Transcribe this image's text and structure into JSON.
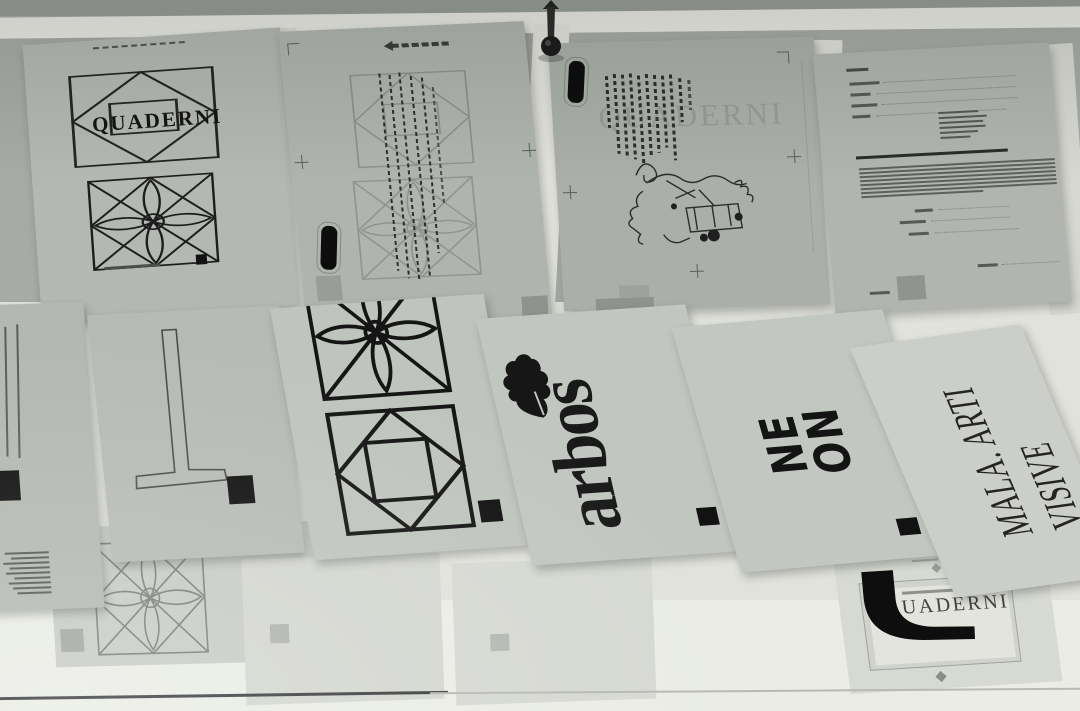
{
  "colors": {
    "ink": "#161616",
    "ink_soft": "#3f423d",
    "wall": "#a7aba5",
    "wall_bright": "#e3e4de",
    "sheet_top_row": "#b2b6b0",
    "sheet_middle_row": "#c2c6c0",
    "sheet_bottom_row": "#d6d8d2"
  },
  "icons": {
    "push_pin": "push-pin",
    "oak_leaf": "oak-leaf",
    "rosette_motif": "petal-rosette",
    "diamond_motif": "diamond-in-square",
    "q_swash": "q-swash-glyph"
  },
  "top_row": {
    "quaderni_sheet": {
      "title": "QUADERNI"
    },
    "ghost_sheet": {
      "ghost_title": "QUADERNI"
    }
  },
  "middle_row": {
    "arbos_sheet": {
      "logo": "arbos"
    },
    "neon_sheet": {
      "logo_line1": "NE",
      "logo_line2": "ON"
    },
    "mala_sheet": {
      "logo": "MALA. ARTI VISIVE"
    }
  },
  "bottom_row": {
    "quaderni_logo_sheet": {
      "wordmark": "UADERNI"
    }
  }
}
